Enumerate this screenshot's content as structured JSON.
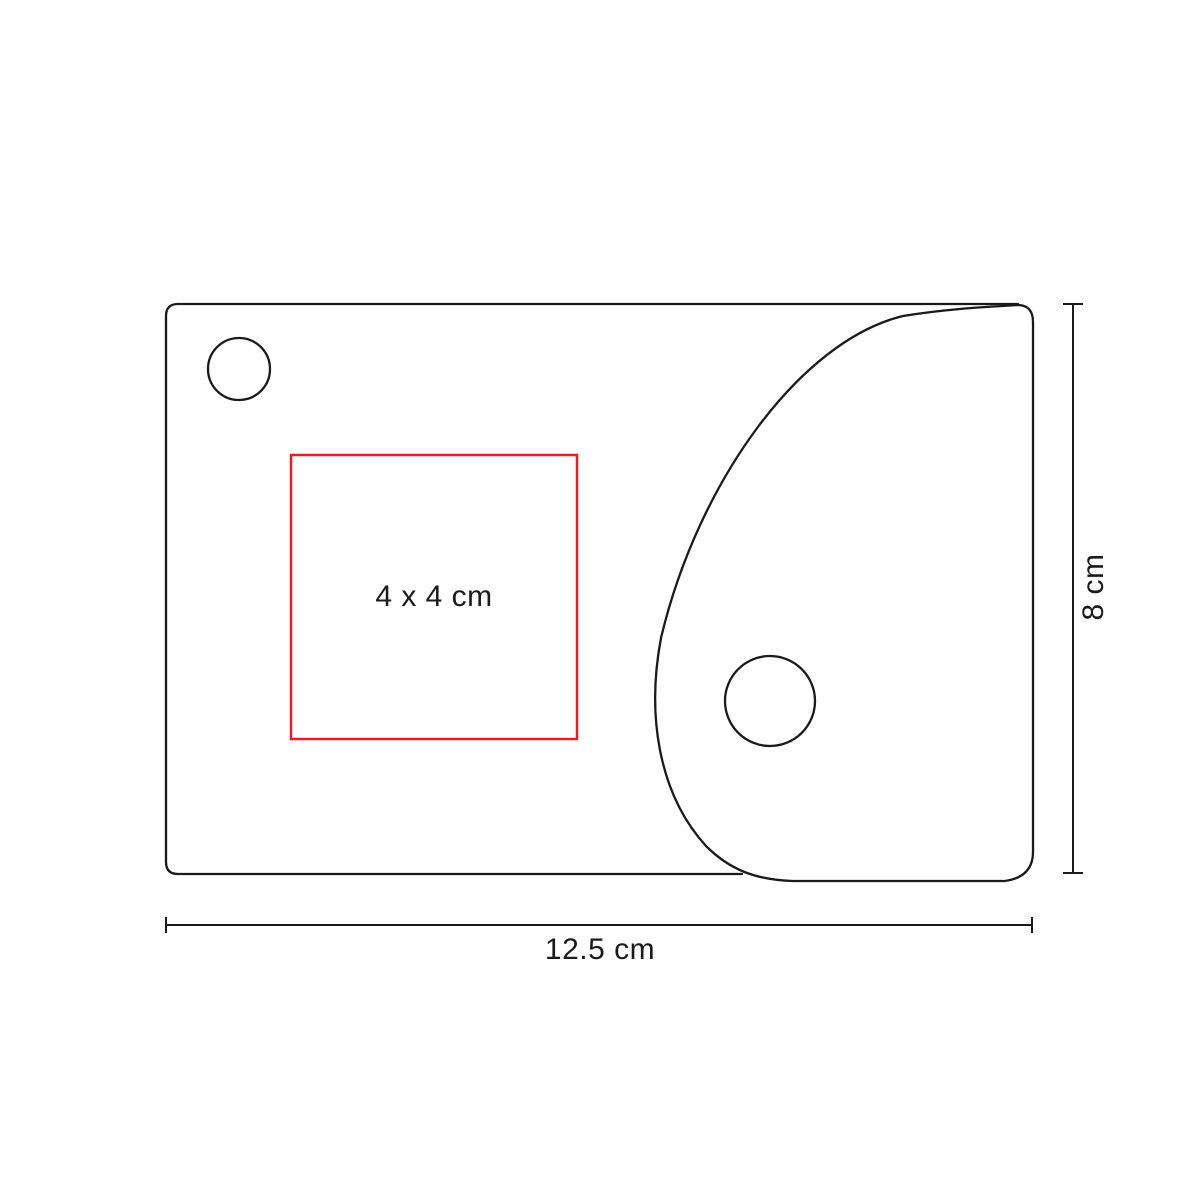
{
  "diagram": {
    "type": "product-dimension-diagram",
    "imprint_area": {
      "label": "4 x 4 cm"
    },
    "width_dimension": {
      "label": "12.5 cm"
    },
    "height_dimension": {
      "label": "8 cm"
    },
    "colors": {
      "outline": "#1a1a1a",
      "imprint_box": "#ed1c24",
      "background": "#ffffff"
    }
  }
}
